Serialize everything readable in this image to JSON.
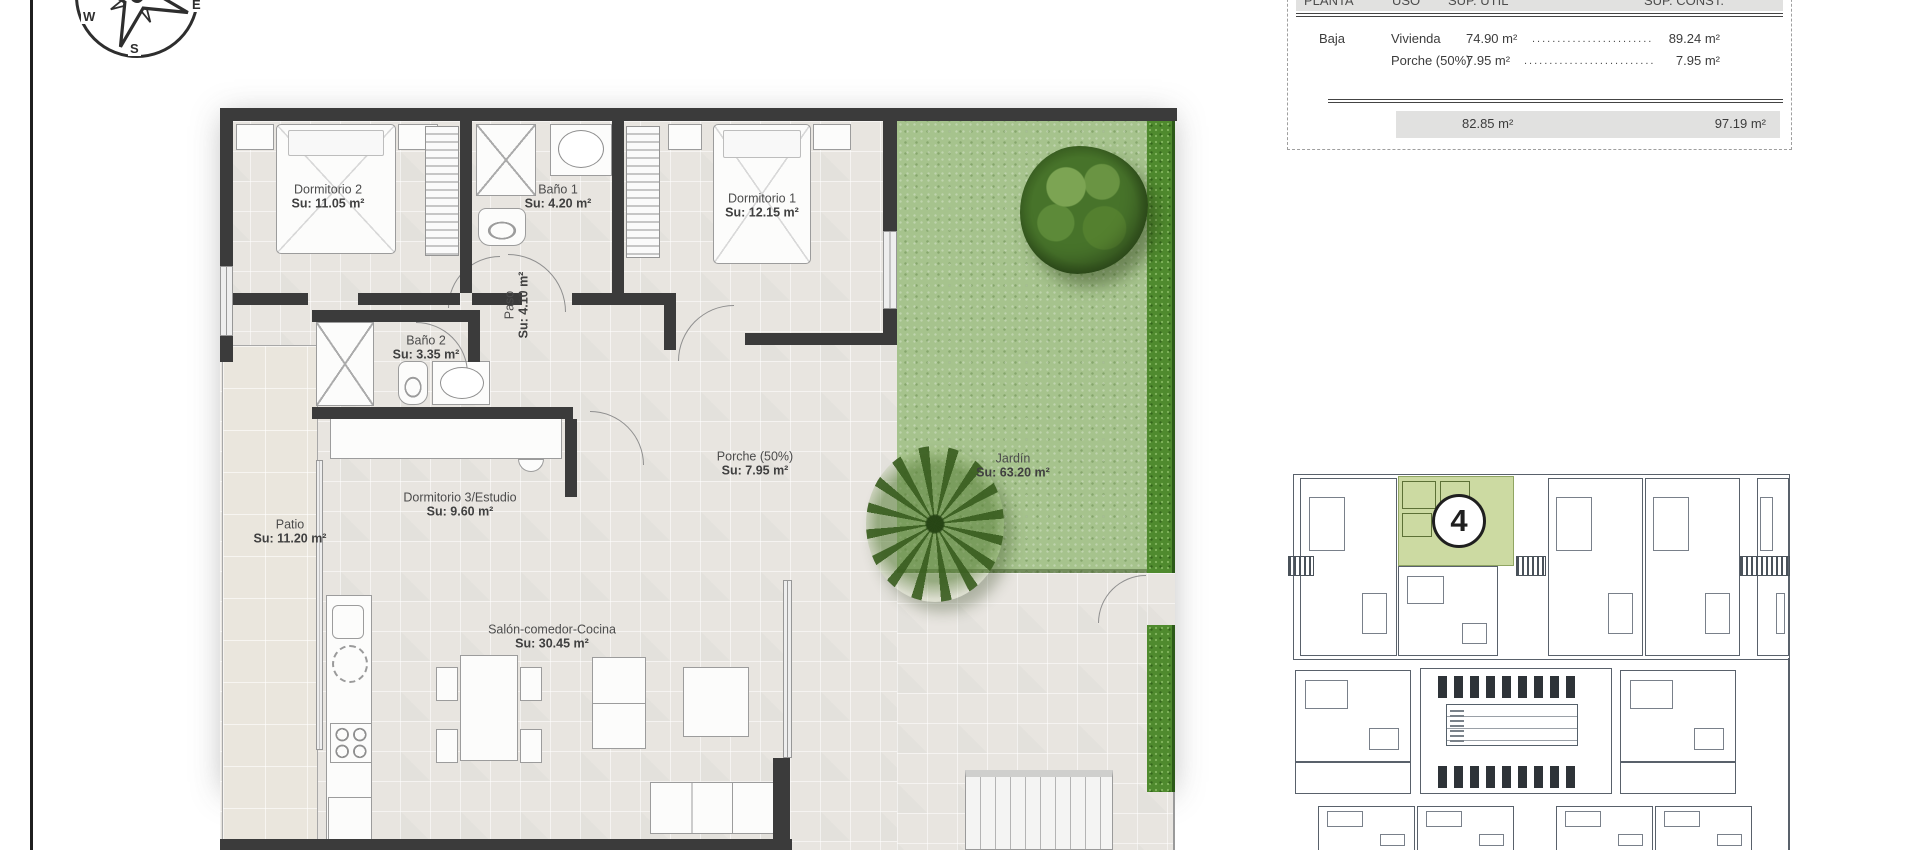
{
  "compass": {
    "w": "W",
    "s": "S",
    "e": "E"
  },
  "area_table": {
    "col_planta": "PLANTA",
    "col_uso": "USO",
    "col_sup_util": "SUP. ÚTIL",
    "col_sup_const": "SUP. CONST.",
    "rows": [
      {
        "planta": "Baja",
        "uso": "Vivienda",
        "sup_util": "74.90 m²",
        "leader": "............................................",
        "sup_const": "89.24 m²"
      },
      {
        "planta": "",
        "uso": "Porche (50%)",
        "sup_util": "7.95 m²",
        "leader": "............................................",
        "sup_const": "7.95 m²"
      }
    ],
    "total_sup_util": "82.85 m²",
    "total_sup_const": "97.19 m²"
  },
  "rooms": [
    {
      "name": "Dormitorio 2",
      "area": "Su: 11.05 m²"
    },
    {
      "name": "Baño 1",
      "area": "Su: 4.20 m²"
    },
    {
      "name": "Dormitorio 1",
      "area": "Su: 12.15 m²"
    },
    {
      "name": "Paso",
      "area": "Su: 4.10 m²"
    },
    {
      "name": "Baño 2",
      "area": "Su: 3.35 m²"
    },
    {
      "name": "Dormitorio 3/Estudio",
      "area": "Su: 9.60 m²"
    },
    {
      "name": "Patio",
      "area": "Su: 11.20 m²"
    },
    {
      "name": "Porche (50%)",
      "area": "Su: 7.95 m²"
    },
    {
      "name": "Salón-comedor-Cocina",
      "area": "Su: 30.45 m²"
    },
    {
      "name": "Jardín",
      "area": "Su: 63.20 m²"
    }
  ],
  "site_plan": {
    "unit_number": "4"
  },
  "colors": {
    "wall": "#3b3b3b",
    "grass": "#a6c38d",
    "grass_border": "#4f8a2e",
    "highlight_unit": "#ccdaa2"
  }
}
